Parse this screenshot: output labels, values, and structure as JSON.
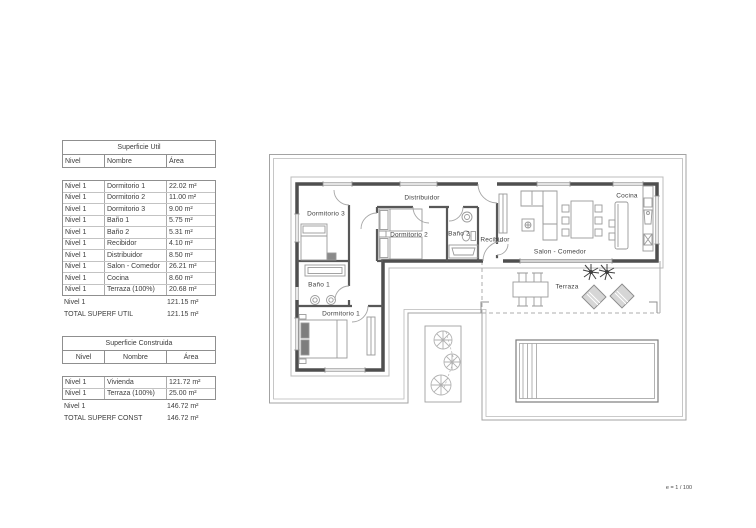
{
  "page": {
    "scale_label": "e = 1 / 100"
  },
  "colors": {
    "text": "#3c3c3c",
    "table_border": "#8f8f8f",
    "row_border": "#c3c3c3",
    "wall": "#4f4f4f",
    "furniture": "#9a9a9a",
    "boundary": "#a3a3a3"
  },
  "tables": [
    {
      "title": "Superficie Util",
      "columns": [
        "Nivel",
        "Nombre",
        "Área"
      ],
      "rows": [
        [
          "Nivel 1",
          "Dormitorio 1",
          "22.02 m²"
        ],
        [
          "Nivel 1",
          "Dormitorio 2",
          "11.00 m²"
        ],
        [
          "Nivel 1",
          "Dormitorio 3",
          "9.00 m²"
        ],
        [
          "Nivel 1",
          "Baño 1",
          "5.75 m²"
        ],
        [
          "Nivel 1",
          "Baño 2",
          "5.31 m²"
        ],
        [
          "Nivel 1",
          "Recibidor",
          "4.10 m²"
        ],
        [
          "Nivel 1",
          "Distribuidor",
          "8.50 m²"
        ],
        [
          "Nivel 1",
          "Salon - Comedor",
          "26.21 m²"
        ],
        [
          "Nivel 1",
          "Cocina",
          "8.60 m²"
        ],
        [
          "Nivel 1",
          "Terraza (100%)",
          "20.68 m²"
        ]
      ],
      "subtotal": {
        "nivel": "Nivel 1",
        "area": "121.15 m²"
      },
      "total": {
        "label": "TOTAL SUPERF UTIL",
        "area": "121.15 m²"
      }
    },
    {
      "title": "Superficie Construida",
      "columns": [
        "Nivel",
        "Nombre",
        "Área"
      ],
      "rows": [
        [
          "Nivel 1",
          "Vivienda",
          "121.72 m²"
        ],
        [
          "Nivel 1",
          "Terraza (100%)",
          "25.00 m²"
        ]
      ],
      "subtotal": {
        "nivel": "Nivel 1",
        "area": "146.72 m²"
      },
      "total": {
        "label": "TOTAL SUPERF CONST",
        "area": "146.72 m²"
      }
    }
  ],
  "plan": {
    "rooms": [
      {
        "id": "dormitorio-3",
        "label": "Dormitorio 3"
      },
      {
        "id": "distribuidor",
        "label": "Distribuidor"
      },
      {
        "id": "dormitorio-2",
        "label": "Dormitorio 2"
      },
      {
        "id": "bano-2",
        "label": "Baño 2"
      },
      {
        "id": "recibidor",
        "label": "Recibidor"
      },
      {
        "id": "salon-comedor",
        "label": "Salon - Comedor"
      },
      {
        "id": "cocina",
        "label": "Cocina"
      },
      {
        "id": "terraza",
        "label": "Terraza"
      },
      {
        "id": "bano-1",
        "label": "Baño 1"
      },
      {
        "id": "dormitorio-1",
        "label": "Dormitorio 1"
      }
    ]
  }
}
